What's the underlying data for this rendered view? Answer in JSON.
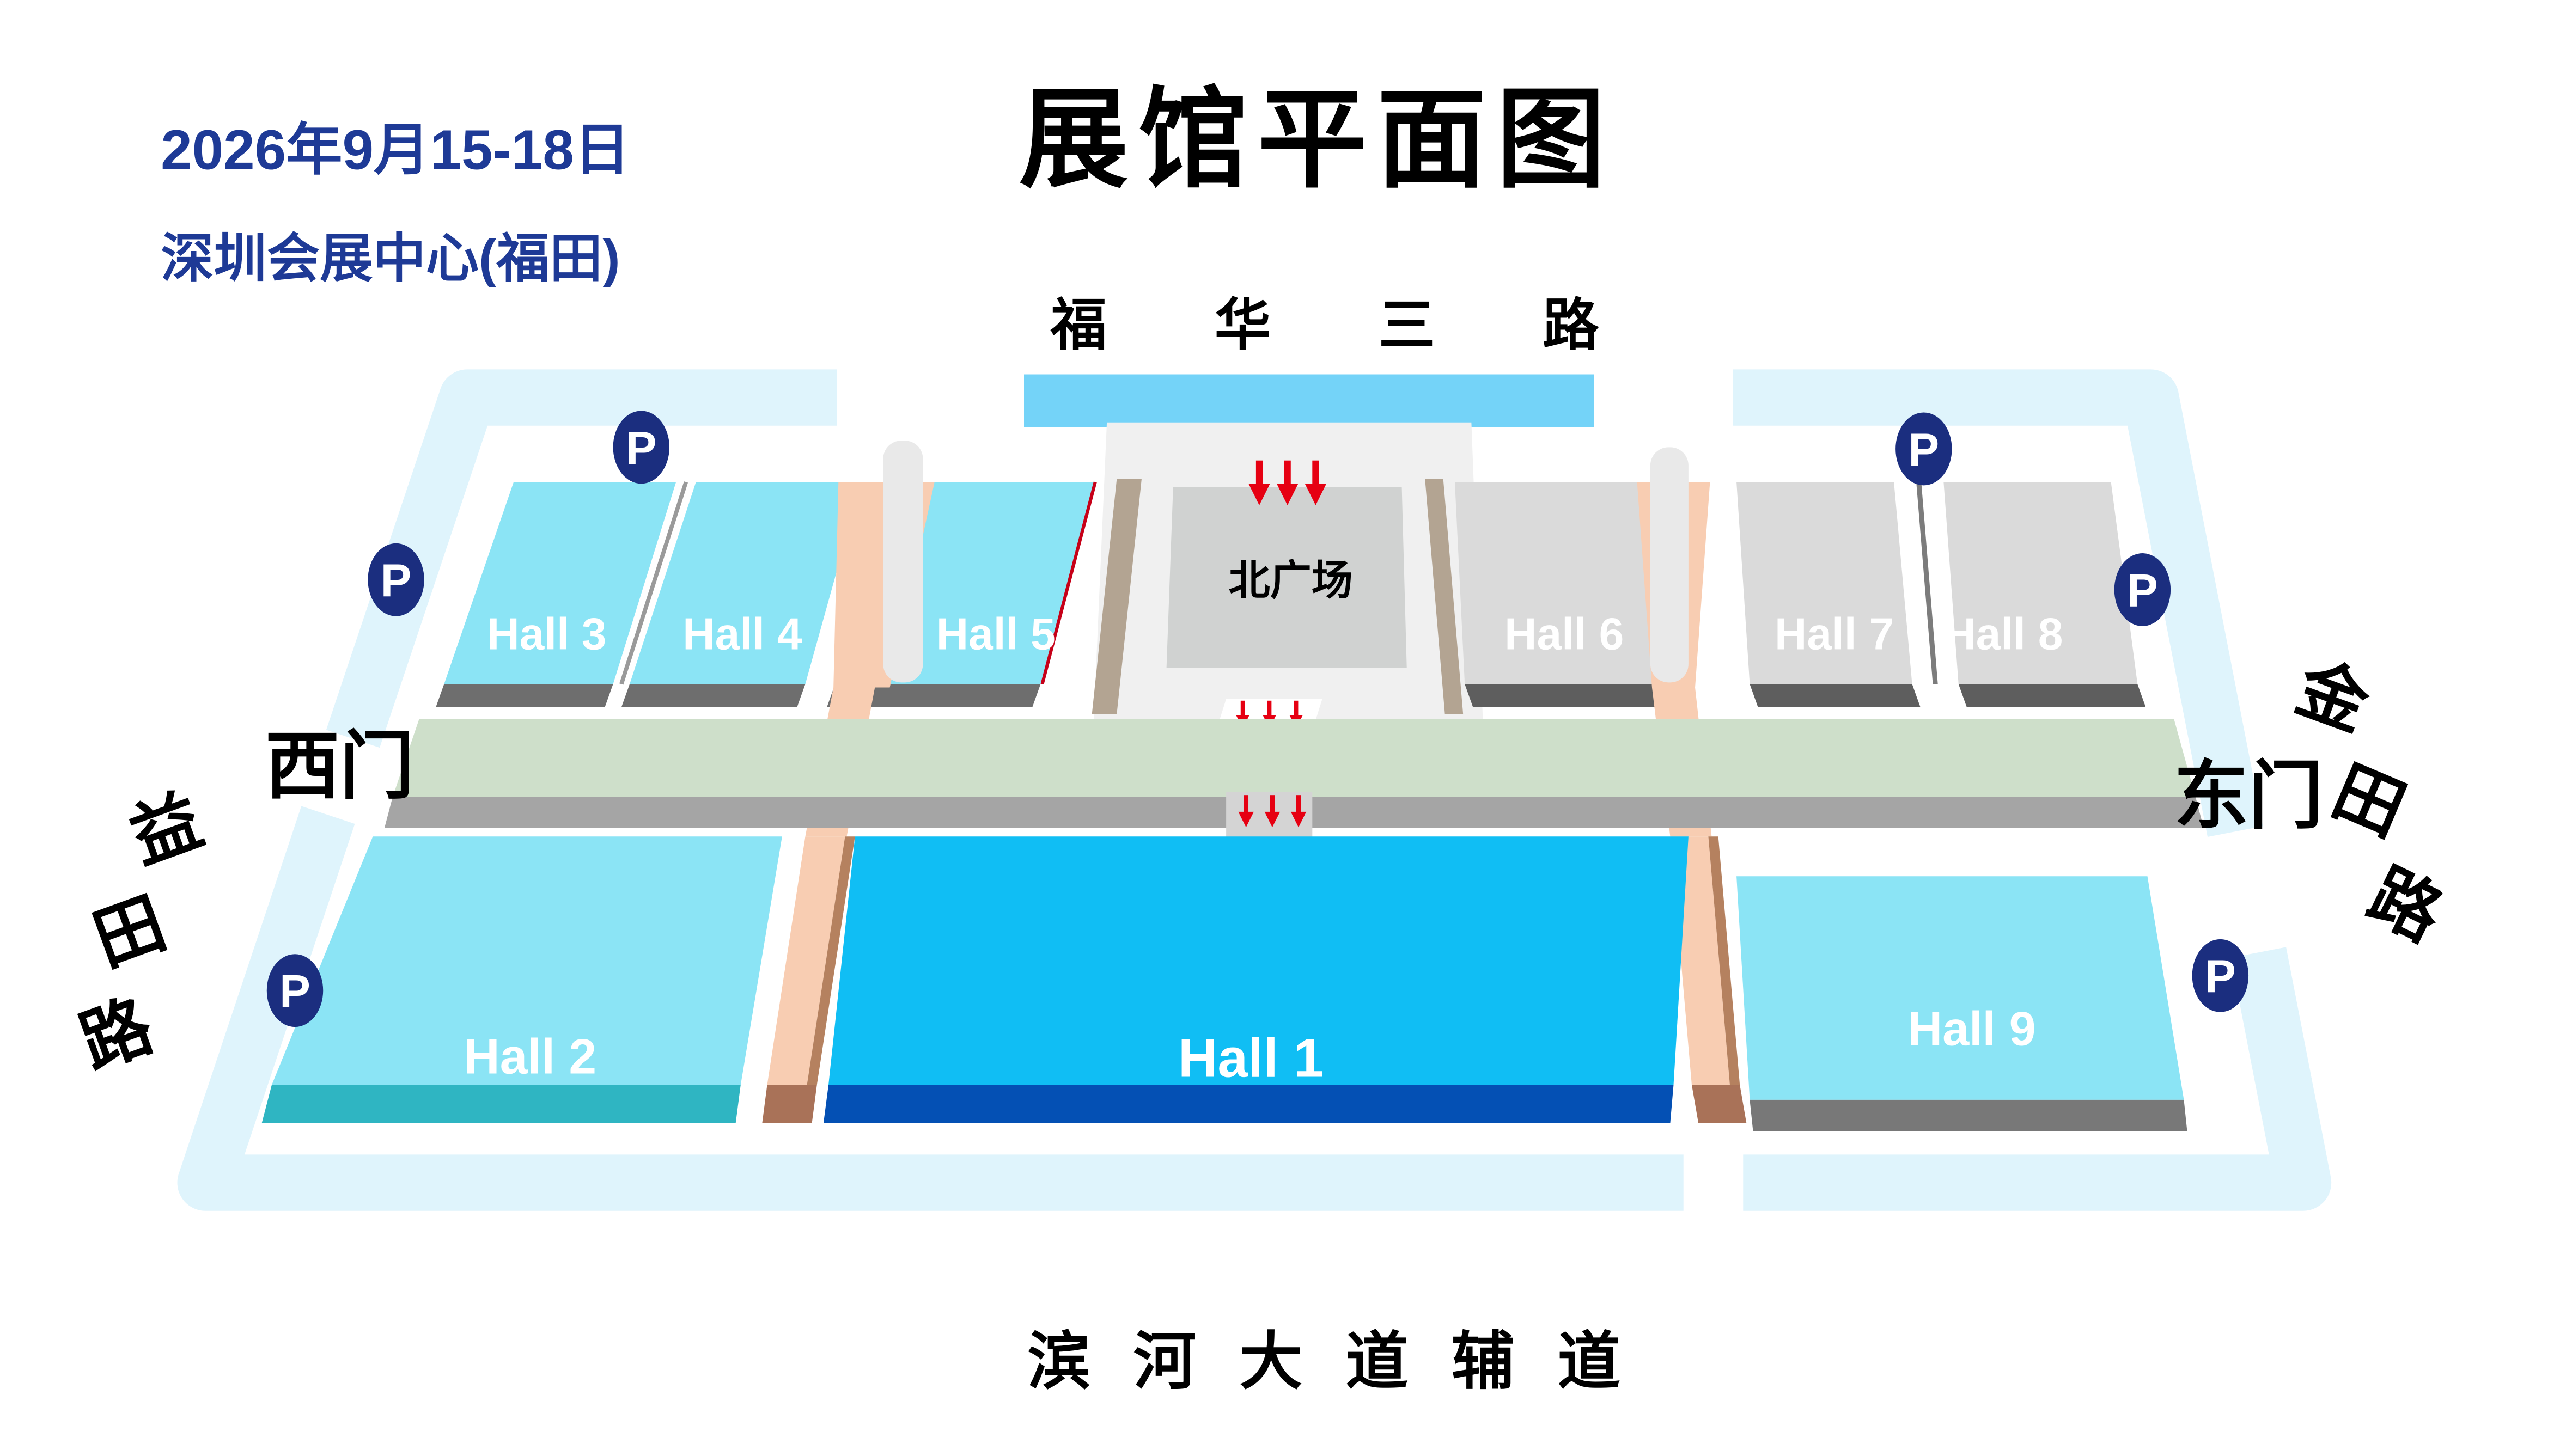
{
  "header": {
    "date_line1": "2026年9月15-18日",
    "venue_line": "深圳会展中心(福田)",
    "title": "展馆平面图"
  },
  "roads": {
    "top": {
      "name": "福华三路"
    },
    "bottom": {
      "name": "滨河大道辅道"
    },
    "left": {
      "name": "益田路",
      "chars": [
        "益",
        "田",
        "路"
      ]
    },
    "right": {
      "name": "金田路",
      "chars": [
        "金",
        "田",
        "路"
      ]
    }
  },
  "gates": {
    "west": "西门",
    "east": "东门"
  },
  "plaza": {
    "label": "北广场"
  },
  "halls": {
    "h1": {
      "label": "Hall 1"
    },
    "h2": {
      "label": "Hall 2"
    },
    "h3": {
      "label": "Hall 3"
    },
    "h4": {
      "label": "Hall 4"
    },
    "h5": {
      "label": "Hall 5"
    },
    "h6": {
      "label": "Hall 6"
    },
    "h7": {
      "label": "Hall 7"
    },
    "h8": {
      "label": "Hall 8"
    },
    "h9": {
      "label": "Hall 9"
    }
  },
  "parking": {
    "symbol": "P",
    "count": 6
  },
  "entrances": {
    "arrow_groups": 3,
    "arrows_per_group": 3
  },
  "colors": {
    "accent_navy": "#1E3A96",
    "road_bar_blue": "#74D3F8",
    "ring_road_blue": "#DFF4FC",
    "hall_cyan": "#8BE4F5",
    "hall_cyan_shadow": "#6E6E6E",
    "hall2_shadow_teal": "#2FB5C2",
    "hall1_blue": "#10BEF4",
    "hall1_shadow": "#0450B4",
    "hall_gray": "#DADADA",
    "hall_gray_shadow": "#5E5E5E",
    "hall9_shadow": "#787878",
    "corridor_green": "#CEDFCA",
    "corridor_side_gray": "#A5A5A5",
    "walkway_pink": "#F8CDB2",
    "walkway_brown": "#A97258",
    "plaza_bg": "#F0F0F0",
    "plaza_inner_gray": "#D0D2D1",
    "plaza_tan": "#B3A492",
    "parking_navy": "#1B2E7F",
    "entrance_arrow_red": "#E60012"
  }
}
